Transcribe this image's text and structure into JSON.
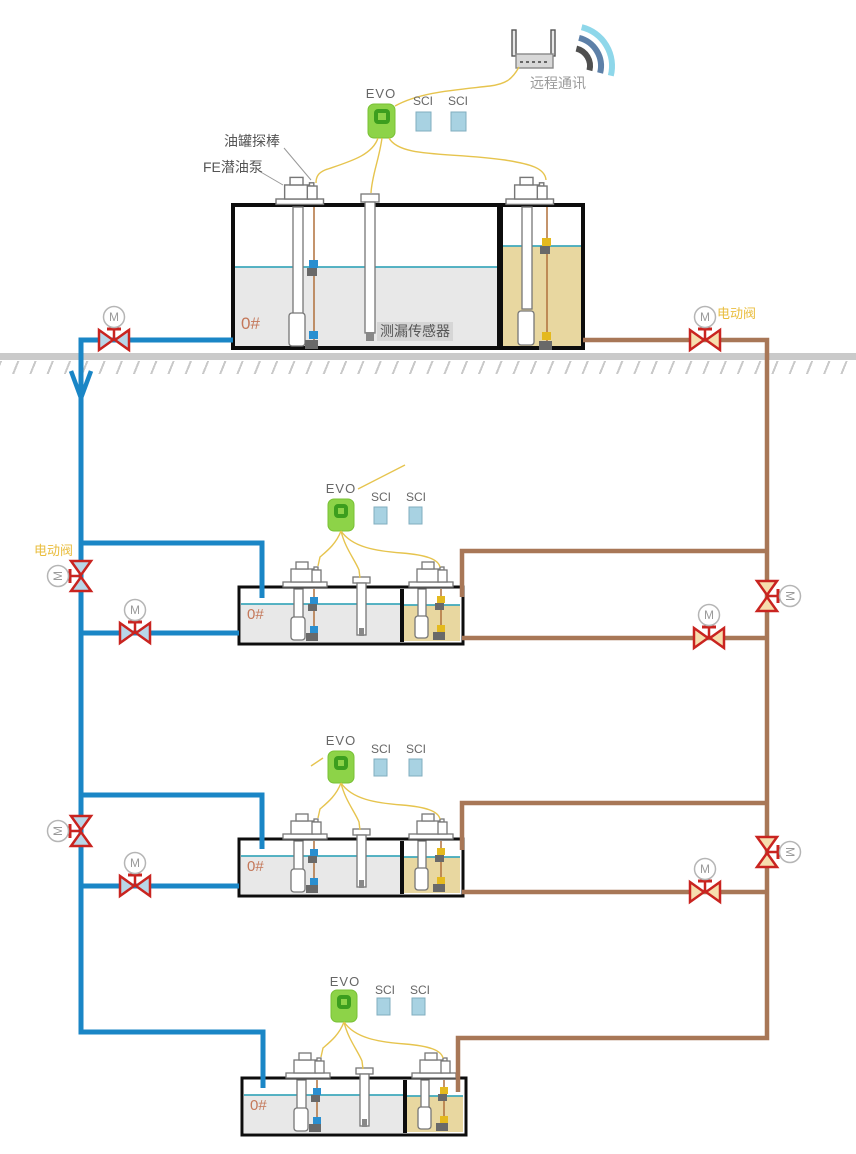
{
  "remote": {
    "label": "远程通讯"
  },
  "annotations": {
    "tank_probe": "油罐探棒",
    "submersible_pump": "FE潜油泵",
    "leak_sensor": "测漏传感器"
  },
  "valves": {
    "motor": "M",
    "electric_valve": "电动阀"
  },
  "stations": [
    {
      "evo": "EVO",
      "sci": [
        "SCI",
        "SCI"
      ],
      "fuel_grade": "0#"
    },
    {
      "evo": "EVO",
      "sci": [
        "SCI",
        "SCI"
      ],
      "fuel_grade": "0#"
    },
    {
      "evo": "EVO",
      "sci": [
        "SCI",
        "SCI"
      ],
      "fuel_grade": "0#"
    },
    {
      "evo": "EVO",
      "sci": [
        "SCI",
        "SCI"
      ],
      "fuel_grade": "0#"
    }
  ],
  "colors": {
    "pipe_blue": "#1a86c6",
    "pipe_brown": "#a87757",
    "valve_red": "#c92420",
    "wire_yellow": "#e6c44e",
    "evo_green": "#8dd348",
    "evo_ring_green": "#3c9e1e",
    "sci_blue": "#a8d2e2",
    "fuel_gray": "#e8e8e8",
    "fuel_yellow": "#e8d7a0",
    "liquid_line_teal": "#3fa9bc",
    "grade_label_orange": "#c4785a",
    "electric_valve_label_yellow": "#e9bd3e"
  }
}
